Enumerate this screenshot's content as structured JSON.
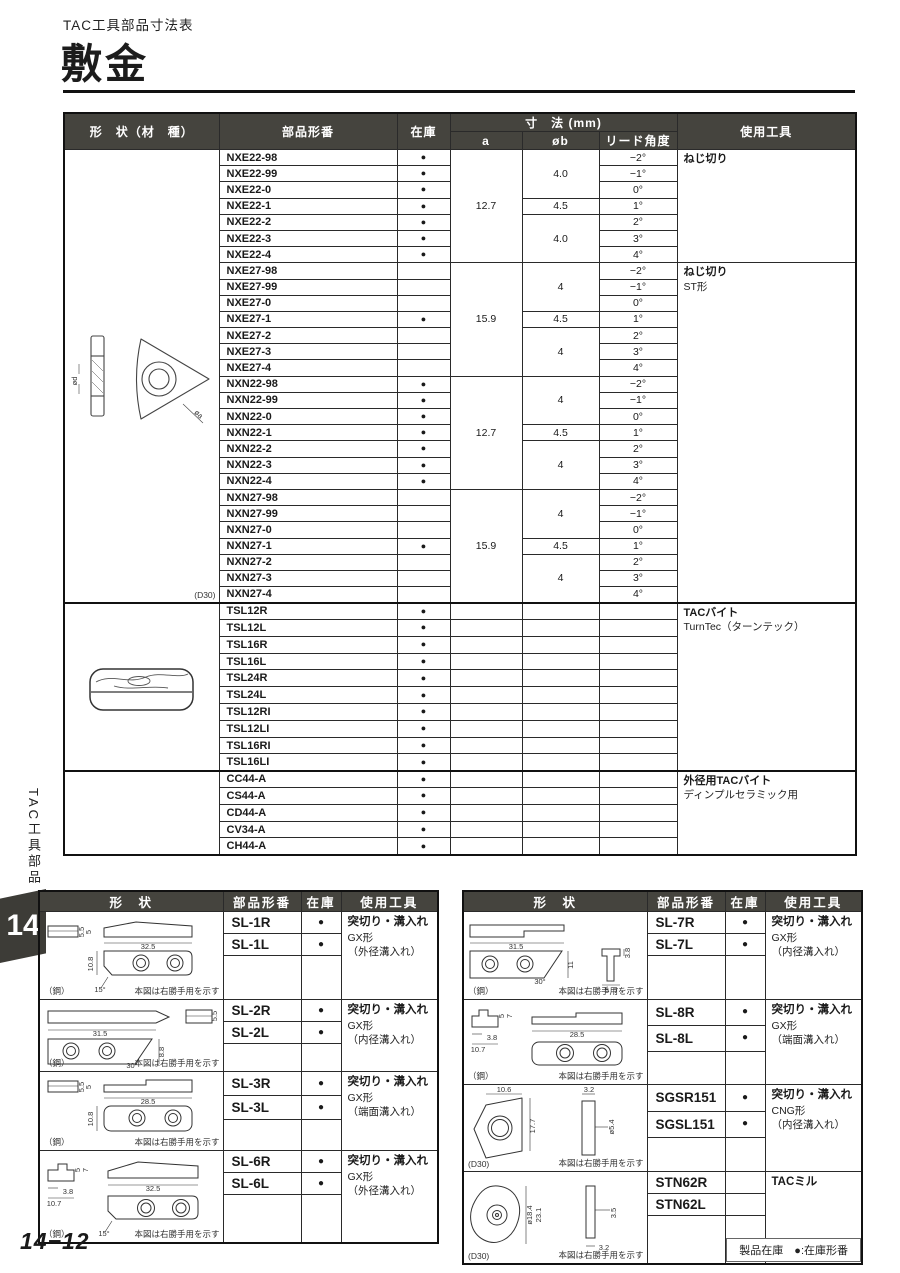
{
  "page": {
    "eyebrow": "TAC工具部品寸法表",
    "title": "敷金",
    "side_tab_text": "TAC工具部品",
    "chapter_number": "14",
    "page_number": "14−12",
    "stock_legend": "製品在庫　●:在庫形番",
    "stock_dot": "●"
  },
  "main_table": {
    "headers": {
      "shape": "形　状（材　種）",
      "part": "部品形番",
      "stock": "在庫",
      "dims_group": "寸　法  (mm)",
      "a": "a",
      "b": "øb",
      "lead": "リード角度",
      "tool": "使用工具"
    },
    "shape_blocks": [
      {
        "rows": 28,
        "drawing": "insert",
        "note": "(D30)",
        "material": ""
      },
      {
        "rows": 10,
        "drawing": "shim",
        "note": "",
        "material": ""
      },
      {
        "rows": 5,
        "drawing": "",
        "note": "",
        "material": ""
      }
    ],
    "tool_blocks": [
      {
        "rows": 7,
        "lines": [
          "ねじ切り"
        ]
      },
      {
        "rows": 21,
        "lines": [
          "ねじ切り",
          "ST形"
        ]
      },
      {
        "rows": 10,
        "lines": [
          "TACバイト",
          "TurnTec（ターンテック）"
        ]
      },
      {
        "rows": 5,
        "lines": [
          "外径用TACバイト",
          "ディンプルセラミック用"
        ]
      }
    ],
    "groups": [
      {
        "a": "12.7",
        "b_spans": [
          {
            "v": "4.0",
            "n": 3
          },
          {
            "v": "4.5",
            "n": 1
          },
          {
            "v": "4.0",
            "n": 3
          }
        ],
        "rows": [
          {
            "part": "NXE22-98",
            "stock": true,
            "lead": "−2°"
          },
          {
            "part": "NXE22-99",
            "stock": true,
            "lead": "−1°"
          },
          {
            "part": "NXE22-0",
            "stock": true,
            "lead": "0°"
          },
          {
            "part": "NXE22-1",
            "stock": true,
            "lead": "1°"
          },
          {
            "part": "NXE22-2",
            "stock": true,
            "lead": "2°"
          },
          {
            "part": "NXE22-3",
            "stock": true,
            "lead": "3°"
          },
          {
            "part": "NXE22-4",
            "stock": true,
            "lead": "4°"
          }
        ]
      },
      {
        "a": "15.9",
        "b_spans": [
          {
            "v": "4",
            "n": 3
          },
          {
            "v": "4.5",
            "n": 1
          },
          {
            "v": "4",
            "n": 3
          }
        ],
        "rows": [
          {
            "part": "NXE27-98",
            "stock": false,
            "lead": "−2°"
          },
          {
            "part": "NXE27-99",
            "stock": false,
            "lead": "−1°"
          },
          {
            "part": "NXE27-0",
            "stock": false,
            "lead": "0°"
          },
          {
            "part": "NXE27-1",
            "stock": true,
            "lead": "1°"
          },
          {
            "part": "NXE27-2",
            "stock": false,
            "lead": "2°"
          },
          {
            "part": "NXE27-3",
            "stock": false,
            "lead": "3°"
          },
          {
            "part": "NXE27-4",
            "stock": false,
            "lead": "4°"
          }
        ]
      },
      {
        "a": "12.7",
        "b_spans": [
          {
            "v": "4",
            "n": 3
          },
          {
            "v": "4.5",
            "n": 1
          },
          {
            "v": "4",
            "n": 3
          }
        ],
        "rows": [
          {
            "part": "NXN22-98",
            "stock": true,
            "lead": "−2°"
          },
          {
            "part": "NXN22-99",
            "stock": true,
            "lead": "−1°"
          },
          {
            "part": "NXN22-0",
            "stock": true,
            "lead": "0°"
          },
          {
            "part": "NXN22-1",
            "stock": true,
            "lead": "1°"
          },
          {
            "part": "NXN22-2",
            "stock": true,
            "lead": "2°"
          },
          {
            "part": "NXN22-3",
            "stock": true,
            "lead": "3°"
          },
          {
            "part": "NXN22-4",
            "stock": true,
            "lead": "4°"
          }
        ]
      },
      {
        "a": "15.9",
        "b_spans": [
          {
            "v": "4",
            "n": 3
          },
          {
            "v": "4.5",
            "n": 1
          },
          {
            "v": "4",
            "n": 3
          }
        ],
        "rows": [
          {
            "part": "NXN27-98",
            "stock": false,
            "lead": "−2°"
          },
          {
            "part": "NXN27-99",
            "stock": false,
            "lead": "−1°"
          },
          {
            "part": "NXN27-0",
            "stock": false,
            "lead": "0°"
          },
          {
            "part": "NXN27-1",
            "stock": true,
            "lead": "1°"
          },
          {
            "part": "NXN27-2",
            "stock": false,
            "lead": "2°"
          },
          {
            "part": "NXN27-3",
            "stock": false,
            "lead": "3°"
          },
          {
            "part": "NXN27-4",
            "stock": false,
            "lead": "4°"
          }
        ]
      },
      {
        "rows": [
          {
            "part": "TSL12R",
            "stock": true,
            "lead": ""
          },
          {
            "part": "TSL12L",
            "stock": true,
            "lead": ""
          },
          {
            "part": "TSL16R",
            "stock": true,
            "lead": ""
          },
          {
            "part": "TSL16L",
            "stock": true,
            "lead": ""
          },
          {
            "part": "TSL24R",
            "stock": true,
            "lead": ""
          },
          {
            "part": "TSL24L",
            "stock": true,
            "lead": ""
          },
          {
            "part": "TSL12RI",
            "stock": true,
            "lead": ""
          },
          {
            "part": "TSL12LI",
            "stock": true,
            "lead": ""
          },
          {
            "part": "TSL16RI",
            "stock": true,
            "lead": ""
          },
          {
            "part": "TSL16LI",
            "stock": true,
            "lead": ""
          }
        ]
      },
      {
        "rows": [
          {
            "part": "CC44-A",
            "stock": true,
            "lead": ""
          },
          {
            "part": "CS44-A",
            "stock": true,
            "lead": ""
          },
          {
            "part": "CD44-A",
            "stock": true,
            "lead": ""
          },
          {
            "part": "CV34-A",
            "stock": true,
            "lead": ""
          },
          {
            "part": "CH44-A",
            "stock": true,
            "lead": ""
          }
        ]
      }
    ]
  },
  "drawings": {
    "insert": {
      "d": "ød",
      "a": "øa"
    },
    "shim": {},
    "sl1": {
      "len": "32.5",
      "ht": "10.8",
      "ang": "15°",
      "s1": "5.5",
      "s2": "5"
    },
    "sl2": {
      "len": "31.5",
      "ht": "8.8",
      "ang": "30°",
      "s1": "5.5",
      "s2": "5"
    },
    "sl3": {
      "len": "28.5",
      "ht": "10.8",
      "s1": "5.5",
      "s2": "5"
    },
    "sl6": {
      "len": "32.5",
      "ang": "15°",
      "s1": "5",
      "s2": "7",
      "s3": "3.8",
      "s4": "10.7"
    },
    "sl7": {
      "len": "31.5",
      "ht": "11",
      "ang": "30°",
      "s1": "3.8",
      "s2": "5",
      "s3": "7"
    },
    "sl8": {
      "len": "28.5",
      "s1": "5",
      "s2": "7",
      "s3": "3.8",
      "s4": "10.7"
    },
    "sgs": {
      "w": "10.6",
      "t": "3.2",
      "h": "17.7",
      "hole": "ø5.4"
    },
    "stn": {
      "dia": "ø18.4",
      "h": "23.1",
      "t1": "3.5",
      "t2": "3.2"
    }
  },
  "bottom_tables": [
    {
      "headers": {
        "shape": "形　状",
        "part": "部品形番",
        "stock": "在庫",
        "tool": "使用工具"
      },
      "blocks": [
        {
          "drawing": "sl1",
          "material": "（鋼）",
          "note": "本図は右勝手用を示す",
          "parts": [
            {
              "part": "SL-1R",
              "stock": true
            },
            {
              "part": "SL-1L",
              "stock": true
            }
          ],
          "tool_lines": [
            "突切り・溝入れ",
            "GX形",
            "（外径溝入れ）"
          ]
        },
        {
          "drawing": "sl2",
          "material": "（鋼）",
          "note": "本図は右勝手用を示す",
          "parts": [
            {
              "part": "SL-2R",
              "stock": true
            },
            {
              "part": "SL-2L",
              "stock": true
            }
          ],
          "tool_lines": [
            "突切り・溝入れ",
            "GX形",
            "（内径溝入れ）"
          ]
        },
        {
          "drawing": "sl3",
          "material": "（鋼）",
          "note": "本図は右勝手用を示す",
          "parts": [
            {
              "part": "SL-3R",
              "stock": true
            },
            {
              "part": "SL-3L",
              "stock": true
            }
          ],
          "tool_lines": [
            "突切り・溝入れ",
            "GX形",
            "（端面溝入れ）"
          ]
        },
        {
          "drawing": "sl6",
          "material": "（鋼）",
          "note": "本図は右勝手用を示す",
          "parts": [
            {
              "part": "SL-6R",
              "stock": true
            },
            {
              "part": "SL-6L",
              "stock": true
            }
          ],
          "tool_lines": [
            "突切り・溝入れ",
            "GX形",
            "（外径溝入れ）"
          ]
        }
      ]
    },
    {
      "headers": {
        "shape": "形　状",
        "part": "部品形番",
        "stock": "在庫",
        "tool": "使用工具"
      },
      "blocks": [
        {
          "drawing": "sl7",
          "material": "（鋼）",
          "note": "本図は右勝手用を示す",
          "parts": [
            {
              "part": "SL-7R",
              "stock": true
            },
            {
              "part": "SL-7L",
              "stock": true
            }
          ],
          "tool_lines": [
            "突切り・溝入れ",
            "GX形",
            "（内径溝入れ）"
          ]
        },
        {
          "drawing": "sl8",
          "material": "（鋼）",
          "note": "本図は右勝手用を示す",
          "parts": [
            {
              "part": "SL-8R",
              "stock": true
            },
            {
              "part": "SL-8L",
              "stock": true
            }
          ],
          "tool_lines": [
            "突切り・溝入れ",
            "GX形",
            "（端面溝入れ）"
          ]
        },
        {
          "drawing": "sgs",
          "material": "(D30)",
          "note": "本図は右勝手用を示す",
          "parts": [
            {
              "part": "SGSR151",
              "stock": true
            },
            {
              "part": "SGSL151",
              "stock": true
            }
          ],
          "tool_lines": [
            "突切り・溝入れ",
            "CNG形",
            "（内径溝入れ）"
          ]
        },
        {
          "drawing": "stn",
          "material": "(D30)",
          "note": "本図は右勝手用を示す",
          "parts": [
            {
              "part": "STN62R",
              "stock": false
            },
            {
              "part": "STN62L",
              "stock": false
            }
          ],
          "tool_lines": [
            "TACミル"
          ]
        }
      ]
    }
  ]
}
